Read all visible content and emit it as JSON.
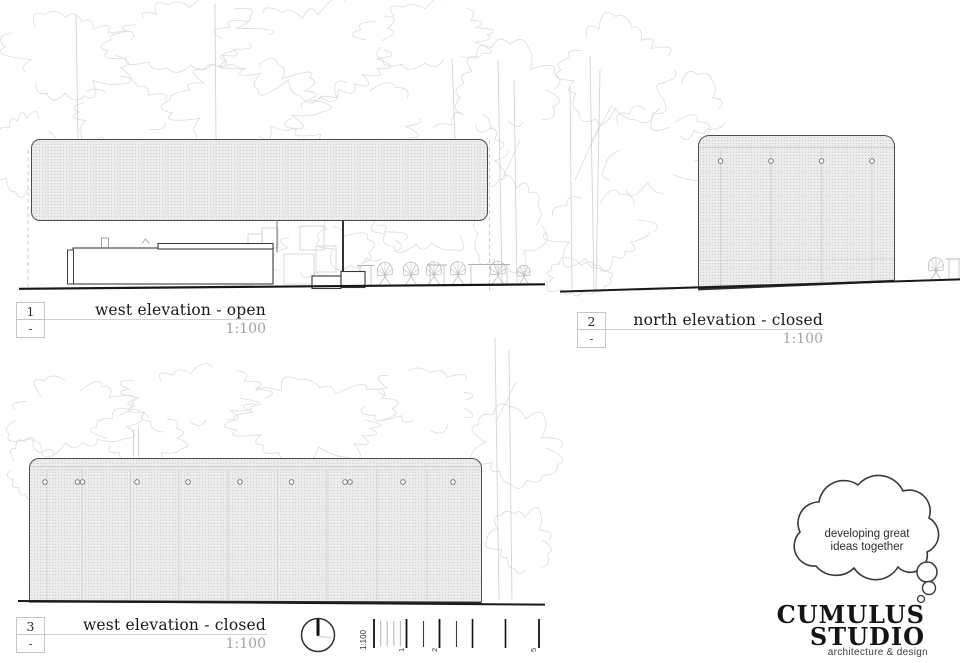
{
  "drawings": [
    {
      "number": "1",
      "revision": "-",
      "title": "west elevation - open",
      "scale": "1:100"
    },
    {
      "number": "2",
      "revision": "-",
      "title": "north elevation - closed",
      "scale": "1:100"
    },
    {
      "number": "3",
      "revision": "-",
      "title": "west elevation - closed",
      "scale": "1:100"
    }
  ],
  "scale_bar": {
    "label": "1:100",
    "tick_labels": [
      "1",
      "2",
      "5"
    ],
    "units_marked": [
      1,
      2,
      5
    ]
  },
  "logo": {
    "tagline_line1": "developing great",
    "tagline_line2": "ideas together",
    "name_line1": "CUMULUS",
    "name_line2": "STUDIO",
    "subtitle": "architecture & design"
  },
  "colors": {
    "paper": "#ffffff",
    "line_dark": "#1a1a1a",
    "line_medium": "#4b4b4b",
    "line_light": "#c9c9c9",
    "tree_sketch": "#dcdcdc",
    "hatch_base": "#ededed",
    "hatch_dot": "#cfcfcf",
    "title_text": "#191919",
    "scale_text": "#a3a3a3"
  }
}
